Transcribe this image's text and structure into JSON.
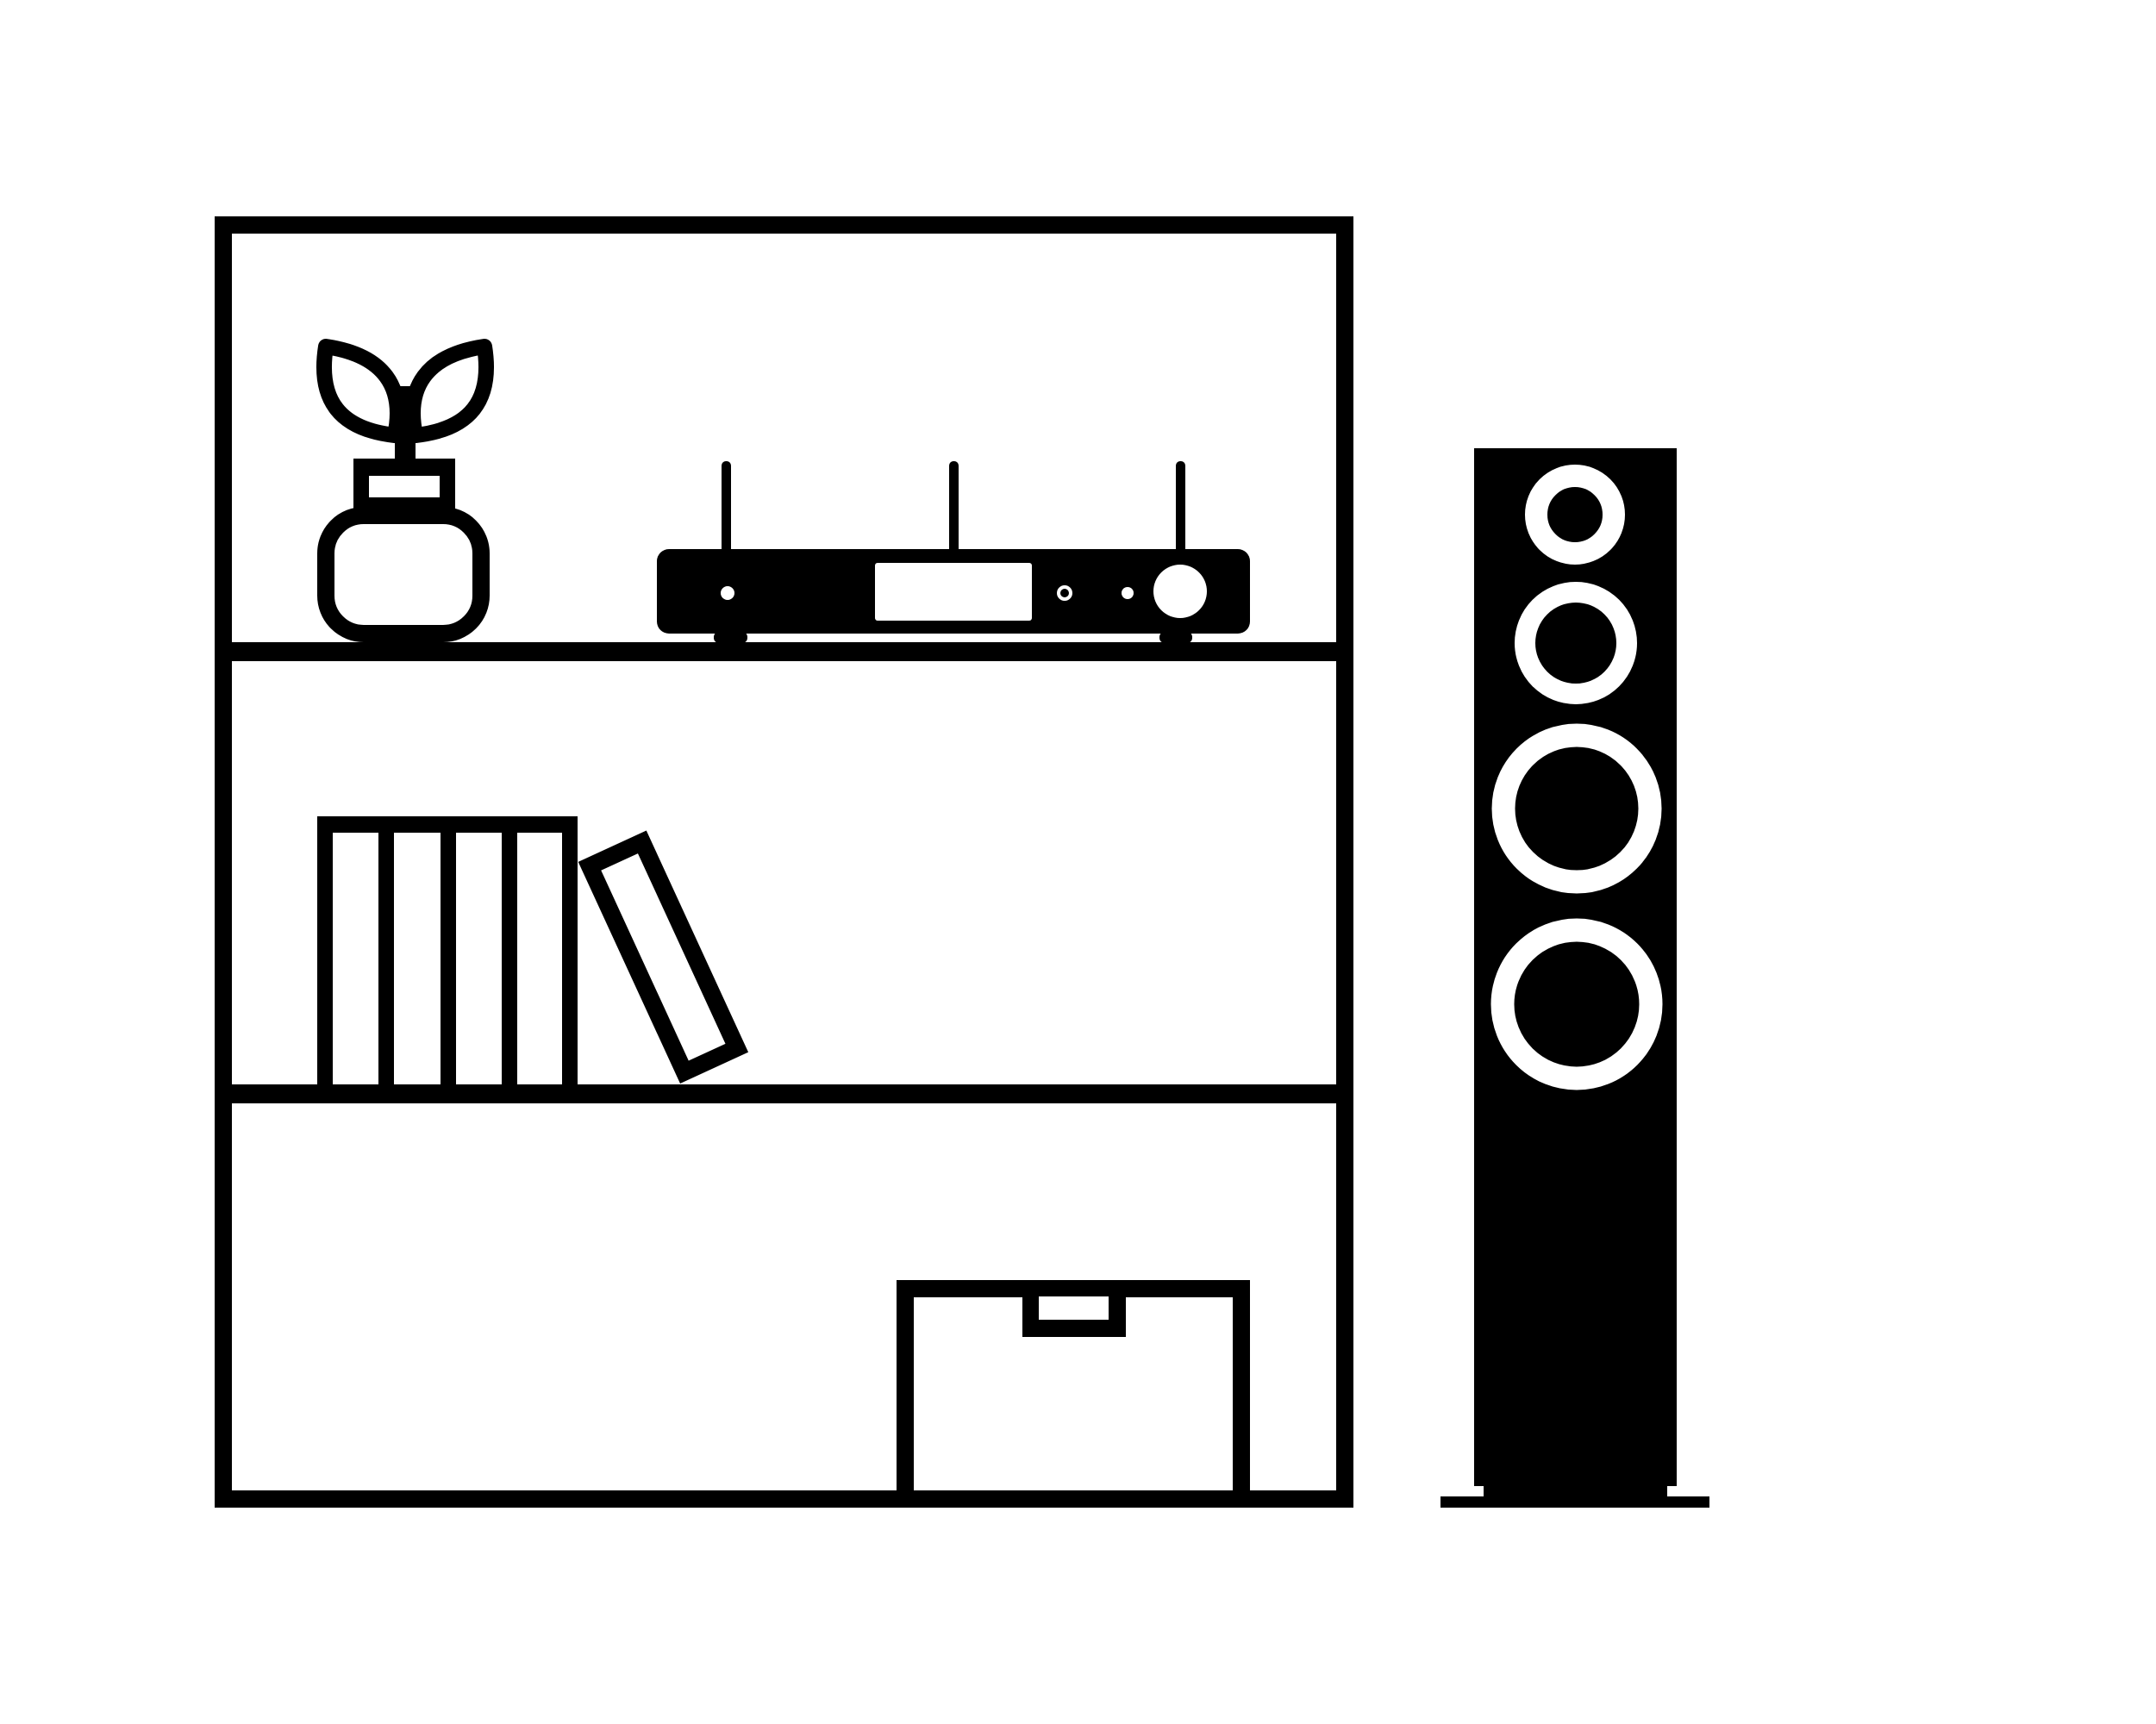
{
  "illustration": {
    "label": "Minimal black and white illustration of a living-room hi-fi setup: a three-shelf bookcase with a potted plant and a network stereo receiver on the top shelf, books on the middle shelf, a storage box on the bottom shelf, and a floor-standing tower speaker to the right",
    "colors": {
      "foreground": "#000000",
      "background": "#ffffff"
    },
    "items": {
      "bookshelf": {
        "label": "bookcase with three shelves",
        "shelf_count": 3
      },
      "plant": {
        "label": "sprouting plant in a round vase",
        "leaf_count": 2
      },
      "receiver": {
        "label": "stereo receiver with antennas, display and volume knob",
        "antenna_count": 3,
        "indicator_count": 3
      },
      "books": {
        "label": "row of upright books with one leaning book",
        "upright_count": 4,
        "leaning_count": 1
      },
      "box": {
        "label": "storage box with handle slot"
      },
      "speaker": {
        "label": "floor-standing tower loudspeaker",
        "driver_count": 4
      }
    }
  }
}
